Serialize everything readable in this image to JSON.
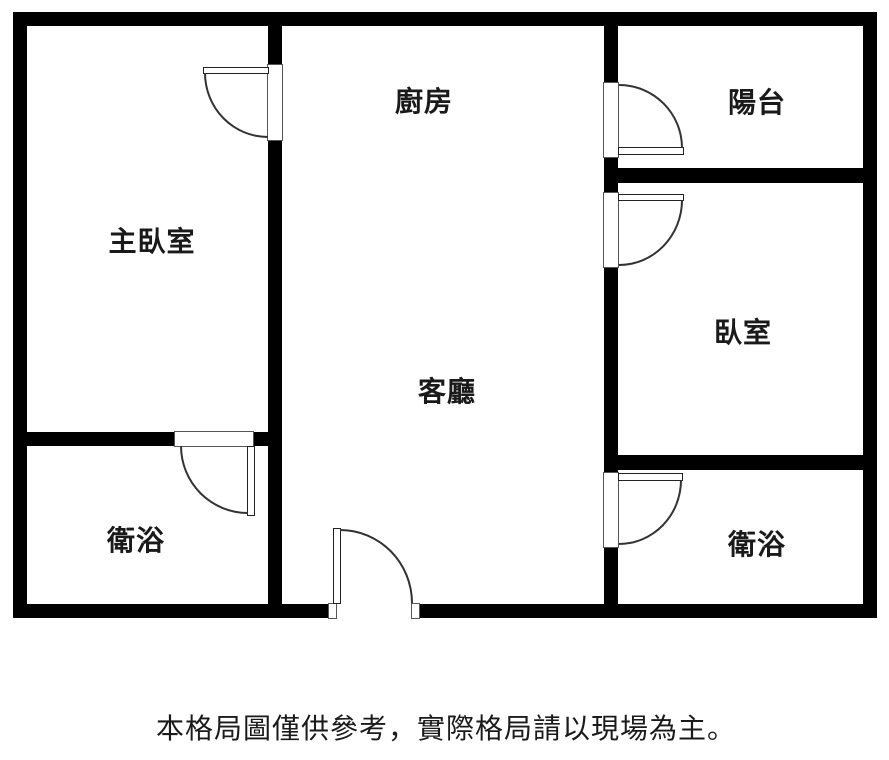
{
  "colors": {
    "background": "#ffffff",
    "wall": "#000000",
    "door_line": "#333333",
    "text": "#1a1a1a"
  },
  "rooms": {
    "master_bedroom": {
      "label": "主臥室"
    },
    "kitchen": {
      "label": "廚房"
    },
    "balcony": {
      "label": "陽台"
    },
    "bedroom": {
      "label": "臥室"
    },
    "living_room": {
      "label": "客廳"
    },
    "bathroom_left": {
      "label": "衛浴"
    },
    "bathroom_right": {
      "label": "衛浴"
    }
  },
  "caption": {
    "text": "本格局圖僅供參考，實際格局請以現場為主。"
  }
}
